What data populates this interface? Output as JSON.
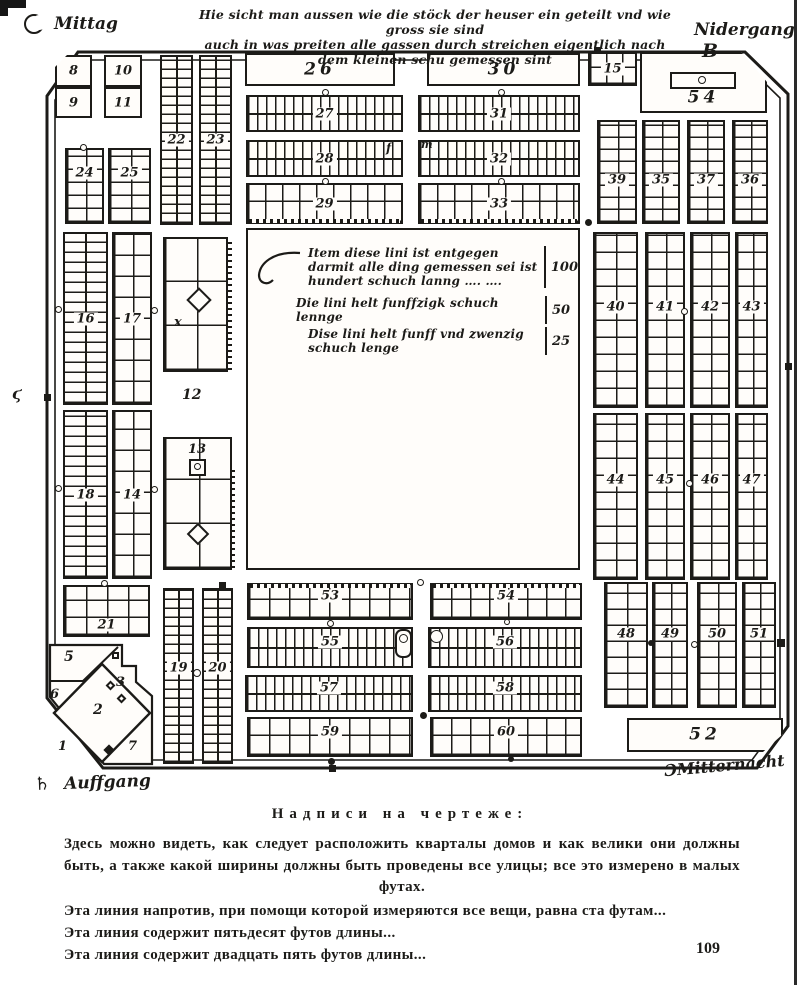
{
  "page": {
    "number": "109",
    "ink": "#1c1b18",
    "paper": "#fffdfa"
  },
  "compass": {
    "top_left_label": "Mittag",
    "top_right_label": "Nidergang",
    "top_right_symbol": "B",
    "bottom_left_symbol": "♄",
    "bottom_left_label": "Auffgang",
    "bottom_right_symbol": "Ɔ",
    "bottom_right_label": "Mitternacht"
  },
  "header_note": {
    "line1": "Hie sicht man aussen wie die stöck der heuser ein geteilt vnd wie gross sie sind",
    "line2": "auch in was preiten alle gassen durch streichen eigentlich nach dem kleinen schu gemessen sint"
  },
  "inscription": {
    "lines": [
      {
        "text": "Item diese lini ist entgegen darmit alle ding gemessen sei ist hundert schuch lanng ….  ….",
        "value": "100"
      },
      {
        "text": "Die lini helt funffzigk schuch lennge",
        "value": "50"
      },
      {
        "text": "Dise lini helt funff vnd zwenzig schuch lenge",
        "value": "25"
      }
    ]
  },
  "caption": {
    "title": "Надписи на чертеже:",
    "paragraph": "Здесь можно видеть, как следует расположить кварталы домов и как велики они должны быть, а также какой ширины должны быть проведены все улицы; все это измерено в малых футах.",
    "lines": [
      "Эта линия напротив, при помощи которой измеряются все вещи, равна ста футам...",
      "Эта линия содержит пятьдесят футов длины...",
      "Эта линия содержит двадцать пять футов длины..."
    ]
  },
  "map": {
    "blocks": [
      {
        "l": "8",
        "x": 55,
        "y": 55,
        "w": 37,
        "h": 32,
        "f": "p",
        "ch": "TL"
      },
      {
        "l": "9",
        "x": 55,
        "y": 87,
        "w": 37,
        "h": 31,
        "f": "p"
      },
      {
        "l": "10",
        "x": 104,
        "y": 55,
        "w": 38,
        "h": 32,
        "f": "p"
      },
      {
        "l": "11",
        "x": 104,
        "y": 87,
        "w": 38,
        "h": 31,
        "f": "p"
      },
      {
        "l": "22",
        "x": 160,
        "y": 55,
        "w": 33,
        "h": 170,
        "f": "h",
        "cy": 9
      },
      {
        "l": "23",
        "x": 199,
        "y": 55,
        "w": 33,
        "h": 170,
        "f": "h",
        "cy": 9
      },
      {
        "l": "24",
        "x": 65,
        "y": 148,
        "w": 39,
        "h": 76,
        "f": "g",
        "cx": 19,
        "cy": 13,
        "dy": -13
      },
      {
        "l": "25",
        "x": 108,
        "y": 148,
        "w": 43,
        "h": 76,
        "f": "g",
        "cx": 21,
        "cy": 13,
        "dy": -13
      },
      {
        "l": "26",
        "x": 245,
        "y": 53,
        "w": 150,
        "h": 33,
        "f": "p",
        "big": 1
      },
      {
        "l": "30",
        "x": 427,
        "y": 53,
        "w": 153,
        "h": 33,
        "f": "p",
        "big": 1
      },
      {
        "l": "27",
        "x": 246,
        "y": 95,
        "w": 157,
        "h": 37,
        "f": "v",
        "cx": 9
      },
      {
        "l": "31",
        "x": 418,
        "y": 95,
        "w": 162,
        "h": 37,
        "f": "v",
        "cx": 9
      },
      {
        "l": "28",
        "x": 246,
        "y": 140,
        "w": 157,
        "h": 37,
        "f": "v",
        "cx": 9
      },
      {
        "l": "32",
        "x": 418,
        "y": 140,
        "w": 162,
        "h": 37,
        "f": "v",
        "cx": 9
      },
      {
        "l": "29",
        "x": 246,
        "y": 183,
        "w": 157,
        "h": 41,
        "f": "g",
        "cx": 17,
        "cy": 20,
        "dotB": 1
      },
      {
        "l": "33",
        "x": 418,
        "y": 183,
        "w": 162,
        "h": 41,
        "f": "g",
        "cx": 17,
        "cy": 20,
        "dotB": 1
      },
      {
        "l": "15",
        "x": 588,
        "y": 52,
        "w": 49,
        "h": 34,
        "f": "g",
        "cx": 16,
        "cy": 16
      },
      {
        "l": "54",
        "x": 640,
        "y": 52,
        "w": 127,
        "h": 61,
        "f": "p",
        "big": 1,
        "ch": "TR",
        "dy": 15
      },
      {
        "l": "39",
        "x": 597,
        "y": 120,
        "w": 40,
        "h": 104,
        "f": "g",
        "cx": 19,
        "cy": 12,
        "dy": 8
      },
      {
        "l": "35",
        "x": 642,
        "y": 120,
        "w": 38,
        "h": 104,
        "f": "g",
        "cx": 18,
        "cy": 12,
        "dy": 8
      },
      {
        "l": "37",
        "x": 687,
        "y": 120,
        "w": 38,
        "h": 104,
        "f": "g",
        "cx": 18,
        "cy": 12,
        "dy": 8
      },
      {
        "l": "36",
        "x": 732,
        "y": 120,
        "w": 36,
        "h": 104,
        "f": "g",
        "cx": 17,
        "cy": 12,
        "dy": 8
      },
      {
        "l": "40",
        "x": 593,
        "y": 232,
        "w": 45,
        "h": 176,
        "f": "g",
        "cx": 21,
        "cy": 17,
        "dy": -13
      },
      {
        "l": "41",
        "x": 645,
        "y": 232,
        "w": 40,
        "h": 176,
        "f": "g",
        "cx": 19,
        "cy": 17,
        "dy": -13
      },
      {
        "l": "42",
        "x": 690,
        "y": 232,
        "w": 40,
        "h": 176,
        "f": "g",
        "cx": 19,
        "cy": 17,
        "dy": -13
      },
      {
        "l": "43",
        "x": 735,
        "y": 232,
        "w": 33,
        "h": 176,
        "f": "g",
        "cx": 16,
        "cy": 17,
        "dy": -13
      },
      {
        "l": "44",
        "x": 593,
        "y": 413,
        "w": 45,
        "h": 167,
        "f": "g",
        "cx": 21,
        "cy": 17,
        "dy": -17
      },
      {
        "l": "45",
        "x": 645,
        "y": 413,
        "w": 40,
        "h": 167,
        "f": "g",
        "cx": 19,
        "cy": 17,
        "dy": -17
      },
      {
        "l": "46",
        "x": 690,
        "y": 413,
        "w": 40,
        "h": 167,
        "f": "g",
        "cx": 19,
        "cy": 17,
        "dy": -17
      },
      {
        "l": "47",
        "x": 735,
        "y": 413,
        "w": 33,
        "h": 167,
        "f": "g",
        "cx": 16,
        "cy": 17,
        "dy": -17
      },
      {
        "l": "48",
        "x": 604,
        "y": 582,
        "w": 44,
        "h": 126,
        "f": "g",
        "cx": 21,
        "cy": 16,
        "dy": -11
      },
      {
        "l": "49",
        "x": 652,
        "y": 582,
        "w": 36,
        "h": 126,
        "f": "g",
        "cx": 17,
        "cy": 16,
        "dy": -11
      },
      {
        "l": "50",
        "x": 697,
        "y": 582,
        "w": 40,
        "h": 126,
        "f": "g",
        "cx": 19,
        "cy": 16,
        "dy": -11
      },
      {
        "l": "51",
        "x": 742,
        "y": 582,
        "w": 34,
        "h": 126,
        "f": "g",
        "cx": 16,
        "cy": 16,
        "dy": -11
      },
      {
        "l": "52",
        "x": 627,
        "y": 718,
        "w": 156,
        "h": 34,
        "f": "p",
        "big": 1,
        "ch": "BR"
      },
      {
        "l": "16",
        "x": 63,
        "y": 232,
        "w": 45,
        "h": 173,
        "f": "h",
        "cy": 10
      },
      {
        "l": "17",
        "x": 112,
        "y": 232,
        "w": 40,
        "h": 173,
        "f": "g",
        "cx": 19,
        "cy": 21
      },
      {
        "l": "18",
        "x": 63,
        "y": 410,
        "w": 45,
        "h": 169,
        "f": "h",
        "cy": 10
      },
      {
        "l": "14",
        "x": 112,
        "y": 410,
        "w": 40,
        "h": 169,
        "f": "g",
        "cx": 19,
        "cy": 21
      },
      {
        "x": 163,
        "y": 237,
        "w": 65,
        "h": 135,
        "f": "g",
        "cx": 32,
        "cy": 44
      },
      {
        "x": 163,
        "y": 437,
        "w": 69,
        "h": 133,
        "f": "g",
        "cx": 34,
        "cy": 44
      },
      {
        "l": "19",
        "x": 163,
        "y": 588,
        "w": 31,
        "h": 176,
        "f": "h",
        "cy": 9,
        "dy": -8
      },
      {
        "l": "20",
        "x": 202,
        "y": 588,
        "w": 31,
        "h": 176,
        "f": "h",
        "cy": 9,
        "dy": -8
      },
      {
        "l": "21",
        "x": 63,
        "y": 585,
        "w": 87,
        "h": 52,
        "f": "g",
        "cx": 21,
        "cy": 17,
        "dy": 14
      },
      {
        "l": "53",
        "x": 247,
        "y": 583,
        "w": 166,
        "h": 37,
        "f": "g",
        "cx": 20,
        "cy": 18,
        "dotT": 1,
        "dy": -6
      },
      {
        "l": "55",
        "x": 247,
        "y": 627,
        "w": 166,
        "h": 41,
        "f": "v",
        "cx": 9,
        "dy": -6
      },
      {
        "l": "57",
        "x": 245,
        "y": 675,
        "w": 168,
        "h": 37,
        "f": "v",
        "cx": 9,
        "dy": -6
      },
      {
        "l": "59",
        "x": 247,
        "y": 717,
        "w": 166,
        "h": 40,
        "f": "g",
        "cx": 20,
        "cy": 19,
        "dy": -5
      },
      {
        "l": "54",
        "x": 430,
        "y": 583,
        "w": 152,
        "h": 37,
        "f": "g",
        "cx": 19,
        "cy": 18,
        "dotT": 1,
        "dy": -6
      },
      {
        "l": "56",
        "x": 428,
        "y": 627,
        "w": 154,
        "h": 41,
        "f": "v",
        "cx": 9,
        "dy": -6
      },
      {
        "l": "58",
        "x": 428,
        "y": 675,
        "w": 154,
        "h": 37,
        "f": "v",
        "cx": 9,
        "dy": -6
      },
      {
        "l": "60",
        "x": 430,
        "y": 717,
        "w": 152,
        "h": 40,
        "f": "g",
        "cx": 19,
        "cy": 19,
        "dy": -5
      }
    ],
    "marks": [
      {
        "t": "circ",
        "x": 80,
        "y": 144,
        "d": 7
      },
      {
        "t": "circ",
        "x": 322,
        "y": 89,
        "d": 7
      },
      {
        "t": "circ",
        "x": 498,
        "y": 89,
        "d": 7
      },
      {
        "t": "circ",
        "x": 322,
        "y": 178,
        "d": 7
      },
      {
        "t": "circ",
        "x": 498,
        "y": 178,
        "d": 7
      },
      {
        "t": "dot",
        "x": 585,
        "y": 219,
        "d": 7
      },
      {
        "t": "circ",
        "x": 55,
        "y": 306,
        "d": 7
      },
      {
        "t": "circ",
        "x": 151,
        "y": 307,
        "d": 7
      },
      {
        "t": "circ",
        "x": 55,
        "y": 485,
        "d": 7
      },
      {
        "t": "circ",
        "x": 151,
        "y": 486,
        "d": 7
      },
      {
        "t": "circ",
        "x": 681,
        "y": 308,
        "d": 7
      },
      {
        "t": "circ",
        "x": 686,
        "y": 480,
        "d": 7
      },
      {
        "t": "dot",
        "x": 648,
        "y": 640,
        "d": 6
      },
      {
        "t": "circ",
        "x": 691,
        "y": 641,
        "d": 7
      },
      {
        "t": "sq",
        "x": 777,
        "y": 639,
        "s": 8
      },
      {
        "t": "circ",
        "x": 193,
        "y": 669,
        "d": 8
      },
      {
        "t": "circ",
        "x": 101,
        "y": 580,
        "d": 7
      },
      {
        "t": "sq",
        "x": 219,
        "y": 582,
        "s": 7
      },
      {
        "t": "circ",
        "x": 417,
        "y": 579,
        "d": 7
      },
      {
        "t": "circ",
        "x": 327,
        "y": 620,
        "d": 7
      },
      {
        "t": "dot",
        "x": 328,
        "y": 758,
        "d": 7
      },
      {
        "t": "dot",
        "x": 420,
        "y": 712,
        "d": 7
      },
      {
        "t": "circ",
        "x": 504,
        "y": 619,
        "d": 6
      },
      {
        "t": "dot",
        "x": 508,
        "y": 756,
        "d": 6
      },
      {
        "t": "circ",
        "x": 430,
        "y": 630,
        "d": 13
      },
      {
        "t": "rect",
        "x": 395,
        "y": 629,
        "w": 17,
        "h": 29,
        "r": 7
      },
      {
        "t": "circ",
        "x": 399,
        "y": 634,
        "d": 9
      },
      {
        "t": "rect",
        "x": 670,
        "y": 72,
        "w": 66,
        "h": 17
      },
      {
        "t": "circ",
        "x": 698,
        "y": 76,
        "d": 8
      },
      {
        "t": "sqo",
        "x": 189,
        "y": 459,
        "s": 17
      },
      {
        "t": "circ",
        "x": 194,
        "y": 463,
        "d": 7
      },
      {
        "t": "diamond",
        "x": 190,
        "y": 291,
        "s": 18
      },
      {
        "t": "diamond",
        "x": 190,
        "y": 526,
        "s": 16
      },
      {
        "t": "diamond",
        "x": 107,
        "y": 682,
        "s": 7
      },
      {
        "t": "diamond",
        "x": 118,
        "y": 695,
        "s": 7
      },
      {
        "t": "diamondF",
        "x": 105,
        "y": 746,
        "s": 8
      },
      {
        "t": "sqo",
        "x": 112,
        "y": 652,
        "s": 7
      },
      {
        "t": "sq",
        "x": 594,
        "y": 47,
        "s": 7
      },
      {
        "t": "sq",
        "x": 44,
        "y": 394,
        "s": 7
      },
      {
        "t": "sq",
        "x": 785,
        "y": 363,
        "s": 7
      },
      {
        "t": "sq",
        "x": 329,
        "y": 765,
        "s": 7
      },
      {
        "t": "hatchv",
        "x": 228,
        "y": 240,
        "w": 4,
        "h": 130
      },
      {
        "t": "hatchv",
        "x": 231,
        "y": 468,
        "w": 4,
        "h": 100
      }
    ],
    "annotations": [
      {
        "t": "12",
        "x": 182,
        "y": 388,
        "fs": 14
      },
      {
        "t": "13",
        "x": 188,
        "y": 443,
        "fs": 13
      },
      {
        "t": "x",
        "x": 174,
        "y": 316,
        "fs": 13
      },
      {
        "t": "f",
        "x": 386,
        "y": 142,
        "fs": 12
      },
      {
        "t": "m",
        "x": 421,
        "y": 139,
        "fs": 11
      },
      {
        "t": "1",
        "x": 58,
        "y": 740,
        "fs": 13
      },
      {
        "t": "2",
        "x": 93,
        "y": 703,
        "fs": 14
      },
      {
        "t": "3",
        "x": 116,
        "y": 676,
        "fs": 13
      },
      {
        "t": "5",
        "x": 64,
        "y": 650,
        "fs": 14
      },
      {
        "t": "6",
        "x": 50,
        "y": 688,
        "fs": 13
      },
      {
        "t": "7",
        "x": 128,
        "y": 740,
        "fs": 13
      },
      {
        "t": "ϛ",
        "x": 12,
        "y": 386,
        "fs": 16
      }
    ]
  }
}
